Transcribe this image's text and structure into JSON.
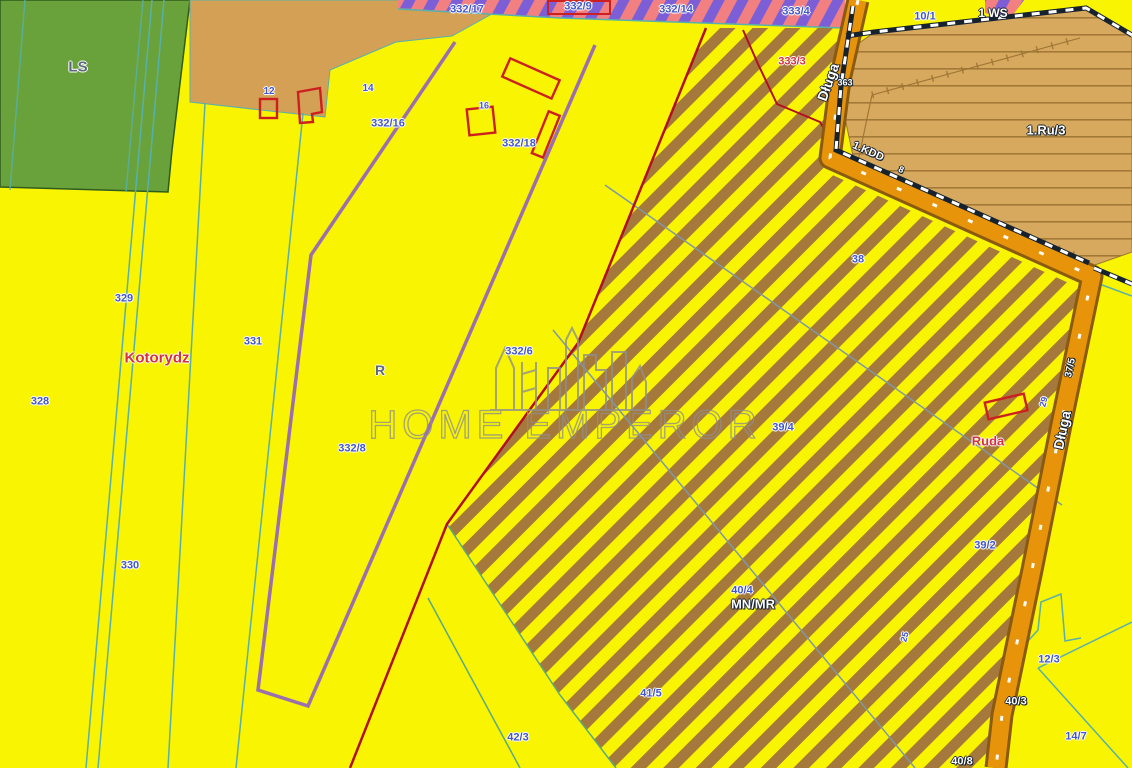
{
  "canvas": {
    "width": 1132,
    "height": 768
  },
  "palette": {
    "yellow": "#f8f402",
    "forest": "#69a13a",
    "forest_edge": "#2f5c1d",
    "tan": "#d4a055",
    "tan2": "#d7a95e",
    "tan_line": "#9c7433",
    "hatch_brown": "#a5793b",
    "pink": "#f28080",
    "purple_stripe": "#7c5fd6",
    "road": "#e8940a",
    "road_edge": "#8a5a10",
    "boundary_red": "#b01020",
    "building_red": "#cc2020",
    "parcel_purple": "#9b6fae",
    "teal": "#58b0ac",
    "tealgreen": "#58aa80",
    "grayblue": "#7d98a8",
    "label_blue": "#4156c8",
    "label_red": "#d33040",
    "label_gray": "#5a6878",
    "dark_line": "#16222e",
    "watermark": "#8f8f8f"
  },
  "watermark": {
    "title": "HOME EMPEROR",
    "logo": "city-skyline"
  },
  "map": {
    "street_name": "Długa",
    "village_name": "Kotorydz",
    "zone_code": "MN/MR",
    "labels": [
      {
        "t": "LS",
        "x": 78,
        "y": 67,
        "c": "gray",
        "s": 15,
        "name": "forest-label-ls"
      },
      {
        "t": "332/17",
        "x": 467,
        "y": 10,
        "c": "blue"
      },
      {
        "t": "332/9",
        "x": 578,
        "y": 7,
        "c": "blue"
      },
      {
        "t": "332/14",
        "x": 676,
        "y": 10,
        "c": "blue"
      },
      {
        "t": "333/4",
        "x": 796,
        "y": 12,
        "c": "blue"
      },
      {
        "t": "10/1",
        "x": 925,
        "y": 17,
        "c": "blue"
      },
      {
        "t": "1 WS",
        "x": 993,
        "y": 13,
        "c": "white",
        "s": 12,
        "name": "zone-label-ws"
      },
      {
        "t": "1.Ru/3",
        "x": 1046,
        "y": 130,
        "c": "white",
        "s": 13,
        "name": "zone-label-ru3"
      },
      {
        "t": "Długa",
        "x": 828,
        "y": 82,
        "c": "white",
        "s": 14,
        "r": -70,
        "name": "street-label-dluga-top"
      },
      {
        "t": "363",
        "x": 845,
        "y": 83,
        "c": "white",
        "s": 9
      },
      {
        "t": "1.KDD",
        "x": 868,
        "y": 152,
        "c": "white",
        "s": 11,
        "r": 24,
        "name": "zone-label-kdd"
      },
      {
        "t": "8",
        "x": 901,
        "y": 170,
        "c": "white",
        "s": 9,
        "r": 24
      },
      {
        "t": "12",
        "x": 269,
        "y": 92,
        "c": "blue",
        "s": 10
      },
      {
        "t": "14",
        "x": 368,
        "y": 89,
        "c": "blue",
        "s": 10
      },
      {
        "t": "16",
        "x": 484,
        "y": 106,
        "c": "blue",
        "s": 9
      },
      {
        "t": "332/16",
        "x": 388,
        "y": 124,
        "c": "blue"
      },
      {
        "t": "332/18",
        "x": 519,
        "y": 144,
        "c": "blue"
      },
      {
        "t": "333/3",
        "x": 792,
        "y": 62,
        "c": "red",
        "s": 11,
        "name": "parcel-label-3333"
      },
      {
        "t": "329",
        "x": 124,
        "y": 299,
        "c": "blue"
      },
      {
        "t": "331",
        "x": 253,
        "y": 342,
        "c": "blue"
      },
      {
        "t": "328",
        "x": 40,
        "y": 402,
        "c": "blue"
      },
      {
        "t": "330",
        "x": 130,
        "y": 566,
        "c": "blue"
      },
      {
        "t": "Kotorydz",
        "x": 157,
        "y": 358,
        "c": "red",
        "s": 15,
        "name": "village-label-kotorydz"
      },
      {
        "t": "R",
        "x": 380,
        "y": 370,
        "c": "gray",
        "s": 14,
        "name": "zone-label-r"
      },
      {
        "t": "332/6",
        "x": 519,
        "y": 352,
        "c": "blue"
      },
      {
        "t": "332/8",
        "x": 352,
        "y": 449,
        "c": "blue"
      },
      {
        "t": "38",
        "x": 858,
        "y": 260,
        "c": "blue"
      },
      {
        "t": "39/4",
        "x": 783,
        "y": 428,
        "c": "blue"
      },
      {
        "t": "37/5",
        "x": 1071,
        "y": 368,
        "c": "white",
        "s": 10,
        "r": -78
      },
      {
        "t": "Długa",
        "x": 1062,
        "y": 430,
        "c": "white",
        "s": 14,
        "r": -78,
        "name": "street-label-dluga-right"
      },
      {
        "t": "29",
        "x": 1044,
        "y": 402,
        "c": "blue",
        "s": 9,
        "r": -75
      },
      {
        "t": "Ruda",
        "x": 988,
        "y": 441,
        "c": "red",
        "s": 13,
        "name": "place-label-ruda"
      },
      {
        "t": "39/2",
        "x": 985,
        "y": 546,
        "c": "blue"
      },
      {
        "t": "40/4",
        "x": 742,
        "y": 591,
        "c": "blue"
      },
      {
        "t": "MN/MR",
        "x": 753,
        "y": 604,
        "c": "white",
        "s": 13,
        "name": "zone-label-mnmr"
      },
      {
        "t": "25",
        "x": 905,
        "y": 637,
        "c": "blue",
        "s": 9,
        "r": -75
      },
      {
        "t": "41/5",
        "x": 651,
        "y": 694,
        "c": "blue"
      },
      {
        "t": "42/3",
        "x": 518,
        "y": 738,
        "c": "blue"
      },
      {
        "t": "12/3",
        "x": 1049,
        "y": 660,
        "c": "blue"
      },
      {
        "t": "14/7",
        "x": 1076,
        "y": 737,
        "c": "blue"
      },
      {
        "t": "40/3",
        "x": 1016,
        "y": 702,
        "c": "white",
        "s": 11
      },
      {
        "t": "40/8",
        "x": 962,
        "y": 762,
        "c": "white",
        "s": 11
      }
    ]
  }
}
